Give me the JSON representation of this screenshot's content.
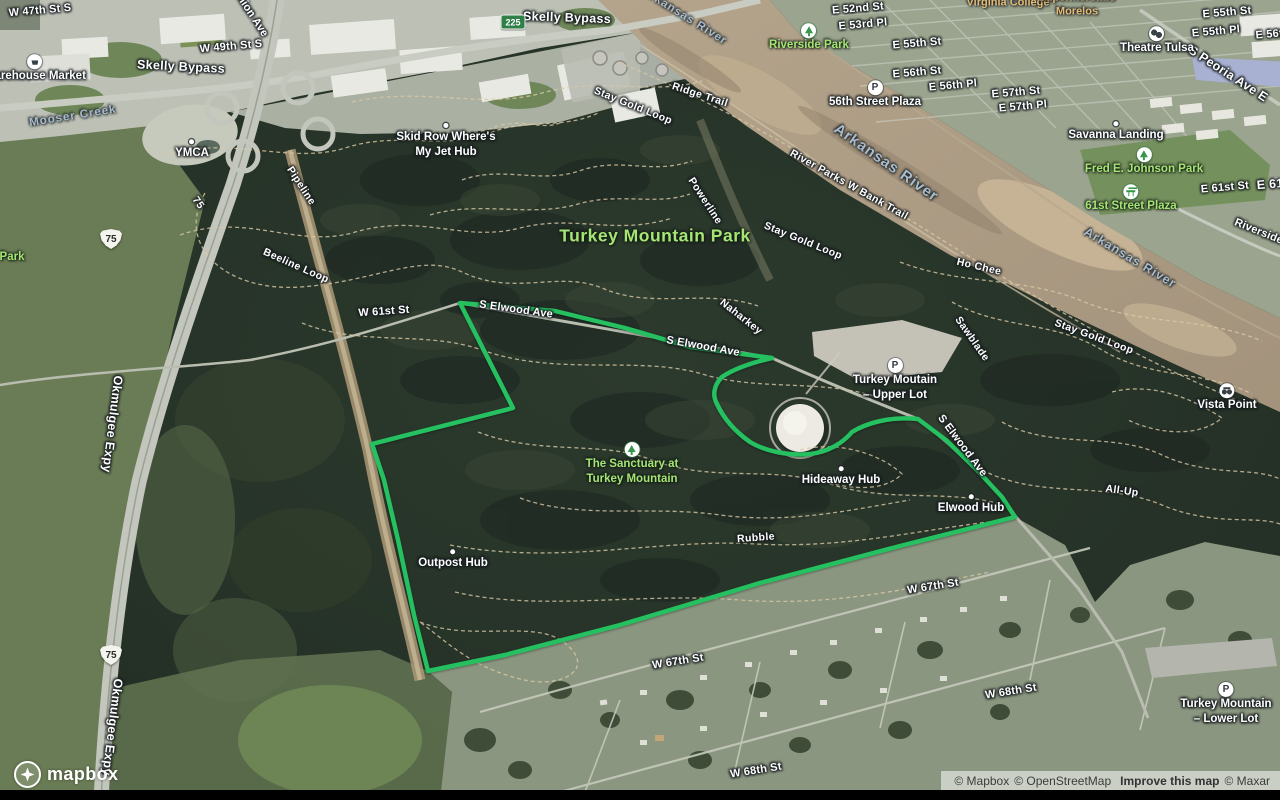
{
  "map": {
    "title": "Turkey Mountain Park satellite map",
    "logo_text": "mapbox",
    "attribution": {
      "items": [
        "© Mapbox",
        "© OpenStreetMap",
        "Improve this map",
        "© Maxar"
      ]
    },
    "colors": {
      "boundary_green": "#25c05f",
      "park_label_green": "#a5e573",
      "water_label_blue": "#a9bccd",
      "poi_orange": "#e3bb76",
      "shield_ok_green": "#2f8048"
    },
    "labels": [
      {
        "name": "label-w-47th-st-s",
        "type": "street",
        "text": "W 47th St S",
        "x": 40,
        "y": 11,
        "rot": -5
      },
      {
        "name": "label-w-49th-st-s",
        "type": "street",
        "text": "W 49th St S",
        "x": 231,
        "y": 47,
        "rot": -5
      },
      {
        "name": "label-union-ave",
        "type": "street",
        "text": "Union Ave",
        "x": 250,
        "y": 13,
        "rot": 57
      },
      {
        "name": "label-skelly-bypass-1",
        "type": "street-lg",
        "text": "Skelly Bypass",
        "x": 567,
        "y": 18,
        "rot": 2
      },
      {
        "name": "label-skelly-bypass-2",
        "type": "street-lg",
        "text": "Skelly Bypass",
        "x": 181,
        "y": 67,
        "rot": 3
      },
      {
        "name": "label-w-61st-st",
        "type": "street",
        "text": "W 61st St",
        "x": 384,
        "y": 312,
        "rot": -4
      },
      {
        "name": "label-s-elwood-ave-1",
        "type": "street",
        "text": "S Elwood Ave",
        "x": 516,
        "y": 310,
        "rot": 8
      },
      {
        "name": "label-s-elwood-ave-2",
        "type": "street",
        "text": "S Elwood Ave",
        "x": 703,
        "y": 347,
        "rot": 10
      },
      {
        "name": "label-s-elwood-ave-3",
        "type": "street",
        "text": "S Elwood Ave",
        "x": 962,
        "y": 446,
        "rot": 53
      },
      {
        "name": "label-okmulgee-expy-1",
        "type": "street-lg",
        "text": "Okmulgee Expy",
        "x": 112,
        "y": 424,
        "rot": 97
      },
      {
        "name": "label-okmulgee-expy-2",
        "type": "street-lg",
        "text": "Okmulgee Expy",
        "x": 112,
        "y": 727,
        "rot": 97
      },
      {
        "name": "label-w-67th-st-1",
        "type": "street",
        "text": "W 67th St",
        "x": 678,
        "y": 662,
        "rot": -9
      },
      {
        "name": "label-w-67th-st-2",
        "type": "street",
        "text": "W 67th St",
        "x": 933,
        "y": 587,
        "rot": -9
      },
      {
        "name": "label-w-68th-st-1",
        "type": "street",
        "text": "W 68th St",
        "x": 756,
        "y": 771,
        "rot": -9
      },
      {
        "name": "label-w-68th-st-2",
        "type": "street",
        "text": "W 68th St",
        "x": 1011,
        "y": 692,
        "rot": -9
      },
      {
        "name": "label-e-52nd-st",
        "type": "street",
        "text": "E 52nd St",
        "x": 858,
        "y": 9,
        "rot": -5
      },
      {
        "name": "label-e-53rd-pl",
        "type": "street",
        "text": "E 53rd Pl",
        "x": 863,
        "y": 25,
        "rot": -5
      },
      {
        "name": "label-e-55th-st-1",
        "type": "street",
        "text": "E 55th St",
        "x": 917,
        "y": 44,
        "rot": -5
      },
      {
        "name": "label-e-55th-st-2",
        "type": "street",
        "text": "E 55th St",
        "x": 1227,
        "y": 13,
        "rot": -5
      },
      {
        "name": "label-e-55th-pl",
        "type": "street",
        "text": "E 55th Pl",
        "x": 1216,
        "y": 32,
        "rot": -5
      },
      {
        "name": "label-e-56th-st-1",
        "type": "street",
        "text": "E 56th St",
        "x": 917,
        "y": 73,
        "rot": -5
      },
      {
        "name": "label-e-56th-pl",
        "type": "street",
        "text": "E 56th Pl",
        "x": 953,
        "y": 86,
        "rot": -5
      },
      {
        "name": "label-e-56th-st-2",
        "type": "street",
        "text": "E 56th St",
        "x": 1280,
        "y": 34,
        "rot": -5
      },
      {
        "name": "label-e-57th-st",
        "type": "street",
        "text": "E 57th St",
        "x": 1016,
        "y": 93,
        "rot": -5
      },
      {
        "name": "label-e-57th-pl",
        "type": "street",
        "text": "E 57th Pl",
        "x": 1023,
        "y": 107,
        "rot": -5
      },
      {
        "name": "label-e-61st-st",
        "type": "street",
        "text": "E 61st St",
        "x": 1225,
        "y": 188,
        "rot": -5
      },
      {
        "name": "label-e-61st",
        "type": "street-lg",
        "text": "E 61st",
        "x": 1276,
        "y": 184,
        "rot": -5
      },
      {
        "name": "label-s-peoria-ave-e",
        "type": "street-lg",
        "text": "S Peoria Ave E",
        "x": 1228,
        "y": 74,
        "rot": 33
      },
      {
        "name": "label-riverside-dr",
        "type": "street",
        "text": "Riverside Dr",
        "x": 1266,
        "y": 235,
        "rot": 22
      },
      {
        "name": "label-mooser-creek",
        "type": "water",
        "text": "Mooser Creek",
        "x": 73,
        "y": 117,
        "rot": -9
      },
      {
        "name": "label-arkansas-river-1",
        "type": "water",
        "text": "Arkansas River",
        "x": 684,
        "y": 17,
        "rot": 32
      },
      {
        "name": "label-arkansas-river-2",
        "type": "water-lg",
        "text": "Arkansas River",
        "x": 886,
        "y": 163,
        "rot": 35
      },
      {
        "name": "label-arkansas-river-3",
        "type": "water",
        "text": "Arkansas River",
        "x": 1130,
        "y": 258,
        "rot": 31,
        "size": 12.5
      },
      {
        "name": "label-ridge-trail",
        "type": "trail",
        "text": "Ridge Trail",
        "x": 700,
        "y": 95,
        "rot": 18
      },
      {
        "name": "label-stay-gold-loop-1",
        "type": "trail",
        "text": "Stay Gold Loop",
        "x": 633,
        "y": 106,
        "rot": 22
      },
      {
        "name": "label-stay-gold-loop-2",
        "type": "trail",
        "text": "Stay Gold Loop",
        "x": 803,
        "y": 241,
        "rot": 22
      },
      {
        "name": "label-stay-gold-loop-3",
        "type": "trail",
        "text": "Stay Gold Loop",
        "x": 1094,
        "y": 337,
        "rot": 20
      },
      {
        "name": "label-powerline",
        "type": "trail",
        "text": "Powerline",
        "x": 705,
        "y": 201,
        "rot": 57
      },
      {
        "name": "label-pipeline",
        "type": "trail",
        "text": "Pipeline",
        "x": 301,
        "y": 186,
        "rot": 57
      },
      {
        "name": "label-75-trail",
        "type": "trail",
        "text": "75",
        "x": 198,
        "y": 203,
        "rot": 55
      },
      {
        "name": "label-beeline-loop",
        "type": "trail",
        "text": "Beeline Loop",
        "x": 296,
        "y": 266,
        "rot": 24
      },
      {
        "name": "label-naharkey",
        "type": "trail",
        "text": "Naharkey",
        "x": 741,
        "y": 317,
        "rot": 38
      },
      {
        "name": "label-river-parks-w-bank-trail",
        "type": "trail",
        "text": "River Parks W Bank Trail",
        "x": 849,
        "y": 185,
        "rot": 29
      },
      {
        "name": "label-ho-chee",
        "type": "trail",
        "text": "Ho Chee",
        "x": 979,
        "y": 267,
        "rot": 13
      },
      {
        "name": "label-sawblade",
        "type": "trail",
        "text": "Sawblade",
        "x": 972,
        "y": 339,
        "rot": 55
      },
      {
        "name": "label-all-up",
        "type": "trail",
        "text": "All-Up",
        "x": 1122,
        "y": 491,
        "rot": 8
      },
      {
        "name": "label-rubble",
        "type": "trail",
        "text": "Rubble",
        "x": 756,
        "y": 538,
        "rot": -4
      },
      {
        "name": "label-turkey-mountain-park",
        "type": "park-title",
        "text": "Turkey Mountain Park",
        "x": 655,
        "y": 236,
        "rot": 0
      },
      {
        "name": "label-riverside-park",
        "type": "park",
        "text": "Riverside Park",
        "x": 809,
        "y": 38,
        "rot": 0,
        "icon": "park-icon"
      },
      {
        "name": "label-fred-e-johnson-park",
        "type": "park",
        "text": "Fred E. Johnson Park",
        "x": 1144,
        "y": 162,
        "rot": 0,
        "icon": "park-icon"
      },
      {
        "name": "label-61st-street-plaza",
        "type": "park",
        "text": "61st Street Plaza",
        "x": 1131,
        "y": 199,
        "rot": 0,
        "icon": "picnic-icon"
      },
      {
        "name": "label-the-sanctuary",
        "type": "park",
        "lines": [
          "The Sanctuary at",
          "Turkey Mountain"
        ],
        "x": 632,
        "y": 464,
        "rot": 0,
        "icon": "park-icon"
      },
      {
        "name": "label-park-partial",
        "type": "park",
        "text": "Park",
        "x": 12,
        "y": 258,
        "rot": 0
      },
      {
        "name": "label-warehouse-market",
        "type": "poi",
        "text": "Warehouse Market",
        "x": 35,
        "y": 69,
        "rot": 0,
        "icon": "market-icon"
      },
      {
        "name": "label-ymca",
        "type": "poi",
        "text": "YMCA",
        "x": 192,
        "y": 150,
        "rot": 0,
        "icon": "dot-icon"
      },
      {
        "name": "label-skid-row-hub",
        "type": "poi",
        "lines": [
          "Skid Row Where's",
          "My Jet Hub"
        ],
        "x": 446,
        "y": 141,
        "rot": 0,
        "icon": "dot-icon"
      },
      {
        "name": "label-theatre-tulsa",
        "type": "poi",
        "text": "Theatre Tulsa",
        "x": 1157,
        "y": 41,
        "rot": 0,
        "icon": "theater-icon"
      },
      {
        "name": "label-savanna-landing",
        "type": "poi",
        "text": "Savanna Landing",
        "x": 1116,
        "y": 132,
        "rot": 0,
        "icon": "dot-icon"
      },
      {
        "name": "label-vista-point",
        "type": "poi",
        "text": "Vista Point",
        "x": 1227,
        "y": 398,
        "rot": 0,
        "icon": "viewpoint-icon"
      },
      {
        "name": "label-56th-street-plaza",
        "type": "poi",
        "text": "56th Street Plaza",
        "x": 875,
        "y": 95,
        "rot": 0,
        "icon": "parking-icon",
        "glyph": "P"
      },
      {
        "name": "label-upper-lot",
        "type": "poi",
        "lines": [
          "Turkey Moutain",
          "– Upper Lot"
        ],
        "x": 895,
        "y": 380,
        "rot": 0,
        "icon": "parking-icon",
        "glyph": "P"
      },
      {
        "name": "label-lower-lot",
        "type": "poi",
        "lines": [
          "Turkey Mountain",
          "– Lower Lot"
        ],
        "x": 1226,
        "y": 704,
        "rot": 0,
        "icon": "parking-icon",
        "glyph": "P"
      },
      {
        "name": "label-hideaway-hub",
        "type": "poi",
        "text": "Hideaway Hub",
        "x": 841,
        "y": 477,
        "rot": 0,
        "icon": "dot-icon"
      },
      {
        "name": "label-elwood-hub",
        "type": "poi",
        "text": "Elwood Hub",
        "x": 971,
        "y": 505,
        "rot": 0,
        "icon": "dot-icon"
      },
      {
        "name": "label-outpost-hub",
        "type": "poi",
        "text": "Outpost Hub",
        "x": 453,
        "y": 560,
        "rot": 0,
        "icon": "dot-icon"
      },
      {
        "name": "label-virginia-college",
        "type": "poi-orange",
        "text": "Virginia College",
        "x": 1008,
        "y": 3,
        "rot": 0
      },
      {
        "name": "label-supermercado-morelos",
        "type": "poi-orange",
        "lines": [
          "Supermercado",
          "Morelos"
        ],
        "x": 1077,
        "y": 5,
        "rot": 0
      },
      {
        "name": "shield-us-75-north",
        "type": "shield-us",
        "text": "75",
        "x": 111,
        "y": 239,
        "rot": 0
      },
      {
        "name": "shield-us-75-south",
        "type": "shield-us",
        "text": "75",
        "x": 111,
        "y": 655,
        "rot": 0
      },
      {
        "name": "shield-ok-225",
        "type": "shield-ok",
        "text": "225",
        "x": 513,
        "y": 22,
        "rot": 0
      }
    ]
  }
}
